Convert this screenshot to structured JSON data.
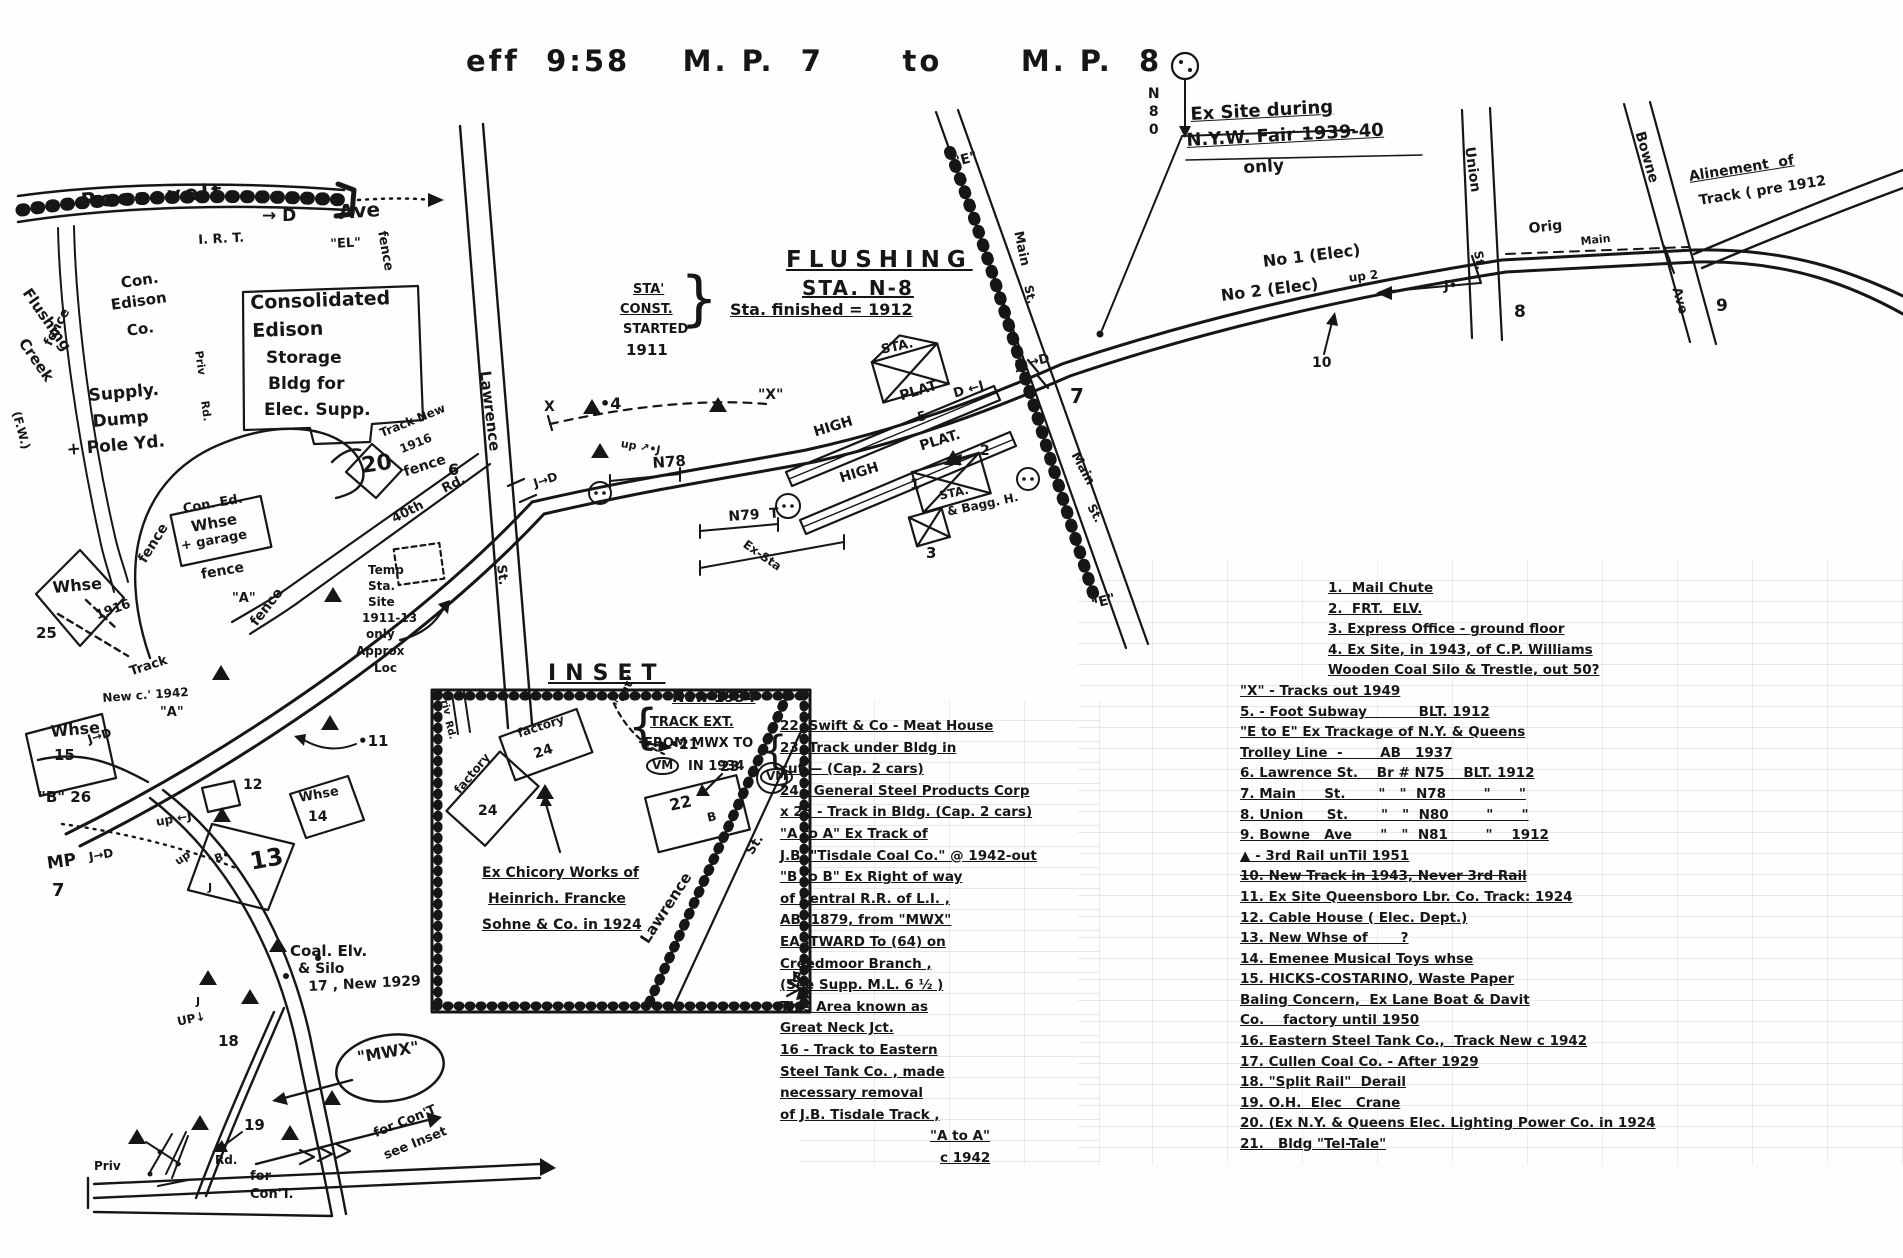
{
  "labels": {
    "title": "eff  9:58    M. P.  7      to      M. P.  8",
    "exsite1": "Ex Site during",
    "exsite2": "N.Y.W. Fair 1939-40",
    "exsite3": "only",
    "n80": "N80",
    "flushing": "FLUSHING",
    "sta_n8": "STA. N-8",
    "finished": "Sta. finished = 1912",
    "const1": "STA'",
    "const2": "CONST.",
    "const3": "STARTED",
    "const4": "1911",
    "brace_r": "}",
    "roosevelt": "Roosevelt",
    "ave": "Ave",
    "irt": "I. R. T.",
    "el": "\"EL\"",
    "d_top": "→ D",
    "creek1": "Flushing",
    "creek2": "Creek",
    "fw": "(F.W.)",
    "con1": "Con.",
    "con2": "Edison",
    "con3": "Co.",
    "cons1": "Consolidated",
    "cons2": "Edison",
    "cons3": "Storage",
    "cons4": "Bldg for",
    "cons5": "Elec. Supp.",
    "sup1": "Supply.",
    "sup2": "Dump",
    "sup3": "+ Pole Yd.",
    "priv": "Priv",
    "rd": "Rd.",
    "tracknew": "Track New",
    "y1916": "1916",
    "n20": "20",
    "fence": "fence",
    "whse": "Whse",
    "ced1": "Con. Ed.",
    "ced3": "+ garage",
    "n25": "25",
    "tn42a": "Track",
    "tn42b": "New c.' 1942",
    "a_q": "\"A\"",
    "n15": "15",
    "jd": "J→D",
    "b26": "\"B\" 26",
    "n12": "12",
    "n14": "14",
    "n13": "13",
    "n11": "•11",
    "up": "up",
    "upj": "up ←J",
    "b_dot": "B•",
    "mp": "MP",
    "n7": "7",
    "j": "J",
    "coal1": "Coal. Elv.",
    "coal2": "& Silo",
    "coal3": "17 , New 1929",
    "n18": "18",
    "updn": "UP↓",
    "n19": "19",
    "mwx": "\"MWX\"",
    "for_": "for",
    "cont": "Con'T.",
    "for_cont": "for Con'T",
    "see_inset": "see Inset",
    "temp1": "Temp",
    "temp2": "Sta.",
    "temp3": "Site",
    "temp4": "1911-13",
    "temp5": "only",
    "temp6": "Approx",
    "temp7": "Loc",
    "n6": "6",
    "lawrence": "Lawrence",
    "st": "St.",
    "n40": "40th",
    "x_l": "X",
    "x_r": "\"X\"",
    "n4": "•4",
    "upj2": "up ↗•J",
    "n78": "N78",
    "n79": "N79  T",
    "ex_sta": "Ex-Sta",
    "high": "HIGH",
    "plat": "PLAT",
    "plat_p": "PLAT.",
    "sta": "STA.",
    "bagg": "& Bagg. H.",
    "n1": "1",
    "n2": "2",
    "n3": "3",
    "n5": "5",
    "dj": "D ←J",
    "jd3": "J•→D",
    "e_q": "\"E\"",
    "main": "Main",
    "no1": "No 1 (Elec)",
    "no2": "No 2 (Elec)",
    "up2": "up 2",
    "n10": "10",
    "j_dot": "J•",
    "n8": "8",
    "n9": "9",
    "union": "Union",
    "bowne": "Bowne",
    "orig": "Orig",
    "alin1": "Alinement  of",
    "alin2": "Track ( pre 1912"
  },
  "legend": {
    "items": [
      "1.  Mail Chute",
      "2.  FRT.  ELV.",
      "3. Express Office - ground floor",
      "4. Ex Site, in 1943, of C.P. Williams",
      "Wooden Coal Silo & Trestle, out 50?",
      "\"X\" - Tracks out 1949",
      "5. - Foot Subway           BLT. 1912",
      "\"E to E\" Ex Trackage of N.Y. & Queens",
      "Trolley Line  -        AB   1937",
      "6. Lawrence St.    Br # N75    BLT. 1912",
      "7. Main      St.       \"   \"  N78        \"      \"",
      "8. Union     St.       \"   \"  N80        \"      \"",
      "9. Bowne   Ave      \"   \"  N81        \"    1912",
      "▲ - 3rd Rail unTil 1951",
      "10. New Track in 1943, Never 3rd Rail",
      "11. Ex Site Queensboro Lbr. Co. Track: 1924",
      "12. Cable House ( Elec. Dept.)",
      "13. New Whse of       ?",
      "14. Emenee Musical Toys whse",
      "15. HICKS-COSTARINO, Waste Paper",
      "Baling Concern,  Ex Lane Boat & Davit",
      "Co.    factory until 1950",
      "16. Eastern Steel Tank Co.,  Track New c 1942",
      "17. Cullen Coal Co. - After 1929",
      "18. \"Split Rail\"  Derail",
      "19. O.H.  Elec   Crane",
      "20. (Ex N.Y. & Queens Elec. Lighting Power Co. in 1924",
      "21.   Bldg \"Tel-Tale\""
    ]
  },
  "notes": {
    "new1934": "New 1934",
    "brace": "{",
    "ext1": "TRACK EXT.",
    "ext2": "FROM MWX TO",
    "vm": "VM",
    "ext3": "IN 1934",
    "items": [
      "22. Swift & Co - Meat House",
      "23. Track under Bldg in",
      "cut — (Cap. 2 cars)",
      "24 - General Steel Products Corp",
      "x 25 - Track in Bldg. (Cap. 2 cars)",
      "\"A to A\" Ex Track of",
      "J.B. \"Tisdale Coal Co.\" @ 1942-out",
      "\"B to B\" Ex Right of way",
      "of Central R.R. of L.I. ,",
      "AB. 1879, from \"MWX\"",
      "EASTWARD To (64) on",
      "Creedmoor Branch ,",
      "(See Supp. M.L. 6 ½ )",
      "This Area known as",
      "Great Neck Jct.",
      "16 - Track to Eastern",
      "Steel Tank Co. , made",
      "necessary removal",
      "of J.B. Tisdale Track ,",
      "\"A to A\"",
      "c 1942"
    ]
  },
  "inset": {
    "title": "INSET",
    "factory": "factory",
    "n24": "24",
    "cut": "\"cut\"",
    "n21": "•21",
    "n23": "23",
    "n22": "22",
    "b": "B",
    "chic1": "Ex Chicory Works of",
    "chic2": "Heinrich. Francke",
    "chic3": "Sohne & Co. in 1924"
  }
}
